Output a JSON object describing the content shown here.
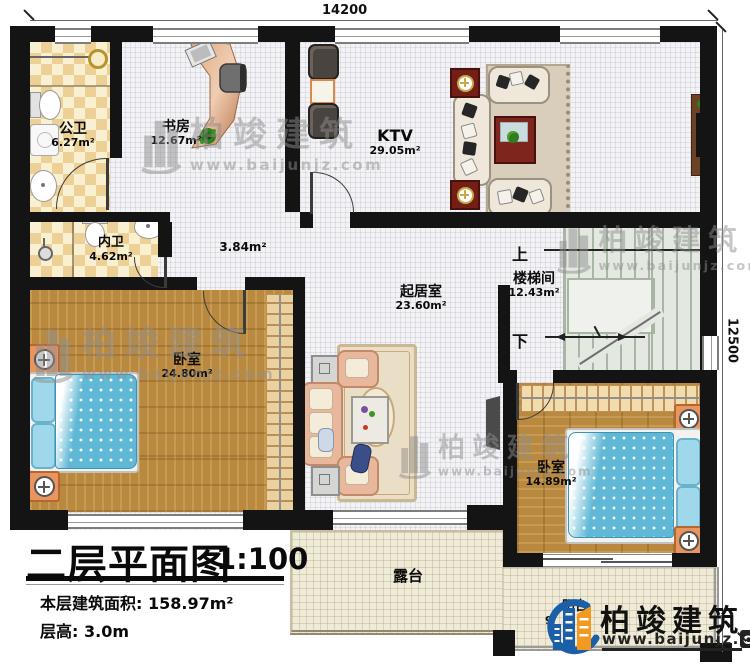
{
  "plan": {
    "title": "二层平面图",
    "scale": "1:100",
    "area_label": "本层建筑面积:",
    "area_value": "158.97m²",
    "height_label": "层高:",
    "height_value": "3.0m"
  },
  "dimensions": {
    "width": "14200",
    "height": "12500"
  },
  "rooms": {
    "public_bath": {
      "name": "公卫",
      "area": "6.27m²"
    },
    "study": {
      "name": "书房",
      "area": "12.67m²"
    },
    "ktv": {
      "name": "KTV",
      "area": "29.05m²"
    },
    "private_bath": {
      "name": "内卫",
      "area": "4.62m²"
    },
    "hallway": {
      "area": "3.84m²"
    },
    "living": {
      "name": "起居室",
      "area": "23.60m²"
    },
    "stairwell": {
      "name": "楼梯间",
      "area": "12.43m²",
      "up_label": "上",
      "down_label": "下"
    },
    "bedroom_left": {
      "name": "卧室",
      "area": "24.80m²"
    },
    "bedroom_right": {
      "name": "卧室",
      "area": "14.89m²"
    },
    "terrace": {
      "name": "露台"
    },
    "balcony": {
      "name": "阳台",
      "area_partial": "9"
    }
  },
  "watermark": {
    "brand": "柏竣建筑",
    "url": "www.baijunjz.com"
  },
  "logo": {
    "brand": "柏竣建筑",
    "url_prefix": "www.baijunjz.",
    "url_tld": "com"
  },
  "colors": {
    "wall": "#141414",
    "brand_blue": "#1a5fa8",
    "brand_orange": "#f2991f",
    "wood": "#b9893f",
    "checker_tan": "#ecd096",
    "stair_green": "#e3e9e0",
    "bed_blue": "#5fb8d6"
  }
}
